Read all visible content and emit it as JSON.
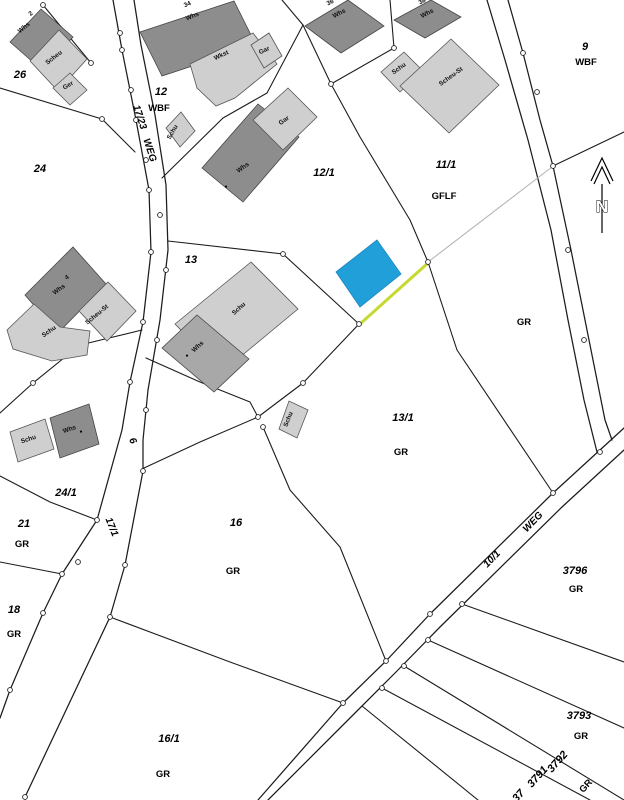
{
  "map": {
    "type": "cadastral-parcel-map",
    "north_label": "N",
    "colors": {
      "highlight_parcel": "#219fd9",
      "highlight_boundary": "#c6d92f",
      "boundary_line": "#1c1c1c",
      "building_dark": "#8d8d8d",
      "building_medium": "#a8a8a8",
      "building_light": "#cfcfcf",
      "auxiliary_line": "#b5b5b5",
      "background": "#ffffff"
    },
    "labels": [
      {
        "t": "26",
        "x": 20,
        "y": 78,
        "r": 0,
        "c": "parcel",
        "n": "parcel-26"
      },
      {
        "t": "24",
        "x": 40,
        "y": 172,
        "r": 0,
        "c": "parcel",
        "n": "parcel-24"
      },
      {
        "t": "12",
        "x": 161,
        "y": 95,
        "r": 0,
        "c": "parcel",
        "n": "parcel-12"
      },
      {
        "t": "WBF",
        "x": 159,
        "y": 111,
        "r": 0,
        "c": "use",
        "n": "use-wbf-12"
      },
      {
        "t": "12/1",
        "x": 324,
        "y": 176,
        "r": 0,
        "c": "parcel",
        "n": "parcel-12-1"
      },
      {
        "t": "11/1",
        "x": 446,
        "y": 168,
        "r": 0,
        "c": "parcel",
        "n": "parcel-11-1"
      },
      {
        "t": "GFLF",
        "x": 444,
        "y": 199,
        "r": 0,
        "c": "use",
        "n": "use-gflf-11-1"
      },
      {
        "t": "9",
        "x": 585,
        "y": 50,
        "r": 0,
        "c": "parcel",
        "n": "parcel-9"
      },
      {
        "t": "WBF",
        "x": 586,
        "y": 65,
        "r": 0,
        "c": "use",
        "n": "use-wbf-9"
      },
      {
        "t": "13",
        "x": 191,
        "y": 263,
        "r": 0,
        "c": "parcel",
        "n": "parcel-13"
      },
      {
        "t": "13/1",
        "x": 403,
        "y": 421,
        "r": 0,
        "c": "parcel",
        "n": "parcel-13-1"
      },
      {
        "t": "GR",
        "x": 401,
        "y": 455,
        "r": 0,
        "c": "use",
        "n": "use-gr-13-1"
      },
      {
        "t": "GR",
        "x": 524,
        "y": 325,
        "r": 0,
        "c": "use",
        "n": "use-gr-right"
      },
      {
        "t": "24/1",
        "x": 66,
        "y": 496,
        "r": 0,
        "c": "parcel",
        "n": "parcel-24-1"
      },
      {
        "t": "21",
        "x": 24,
        "y": 527,
        "r": 0,
        "c": "parcel",
        "n": "parcel-21"
      },
      {
        "t": "GR",
        "x": 22,
        "y": 547,
        "r": 0,
        "c": "use",
        "n": "use-gr-21"
      },
      {
        "t": "16",
        "x": 236,
        "y": 526,
        "r": 0,
        "c": "parcel",
        "n": "parcel-16"
      },
      {
        "t": "GR",
        "x": 233,
        "y": 574,
        "r": 0,
        "c": "use",
        "n": "use-gr-16"
      },
      {
        "t": "18",
        "x": 14,
        "y": 613,
        "r": 0,
        "c": "parcel",
        "n": "parcel-18"
      },
      {
        "t": "GR",
        "x": 14,
        "y": 637,
        "r": 0,
        "c": "use",
        "n": "use-gr-18"
      },
      {
        "t": "16/1",
        "x": 169,
        "y": 742,
        "r": 0,
        "c": "parcel",
        "n": "parcel-16-1"
      },
      {
        "t": "GR",
        "x": 163,
        "y": 777,
        "r": 0,
        "c": "use",
        "n": "use-gr-16-1"
      },
      {
        "t": "3796",
        "x": 575,
        "y": 574,
        "r": 0,
        "c": "parcel",
        "n": "parcel-3796"
      },
      {
        "t": "GR",
        "x": 576,
        "y": 592,
        "r": 0,
        "c": "use",
        "n": "use-gr-3796"
      },
      {
        "t": "3793",
        "x": 579,
        "y": 719,
        "r": 0,
        "c": "parcel",
        "n": "parcel-3793"
      },
      {
        "t": "GR",
        "x": 581,
        "y": 739,
        "r": 0,
        "c": "use",
        "n": "use-gr-3793"
      },
      {
        "t": "3792",
        "x": 560,
        "y": 764,
        "r": -48,
        "c": "parcel",
        "n": "parcel-3792"
      },
      {
        "t": "3791",
        "x": 540,
        "y": 779,
        "r": -48,
        "c": "parcel",
        "n": "parcel-3791"
      },
      {
        "t": "GR",
        "x": 588,
        "y": 788,
        "r": -48,
        "c": "use",
        "n": "use-gr-3792"
      },
      {
        "t": "37",
        "x": 521,
        "y": 798,
        "r": -48,
        "c": "parcel",
        "n": "parcel-37-clipped"
      },
      {
        "t": "17/23",
        "x": 137,
        "y": 118,
        "r": 72,
        "c": "road",
        "n": "road-17-23"
      },
      {
        "t": "WEG",
        "x": 147,
        "y": 151,
        "r": 72,
        "c": "road",
        "n": "road-weg-left"
      },
      {
        "t": "6",
        "x": 130,
        "y": 442,
        "r": 65,
        "c": "road",
        "n": "road-6"
      },
      {
        "t": "17/1",
        "x": 109,
        "y": 528,
        "r": 68,
        "c": "road",
        "n": "road-17-1"
      },
      {
        "t": "10/1",
        "x": 494,
        "y": 561,
        "r": -46,
        "c": "road",
        "n": "road-10-1"
      },
      {
        "t": "WEG",
        "x": 535,
        "y": 524,
        "r": -46,
        "c": "road",
        "n": "road-weg-right"
      },
      {
        "t": "Whs",
        "x": 25,
        "y": 29,
        "r": -40,
        "c": "bld",
        "n": "bld-whs-26"
      },
      {
        "t": "2",
        "x": 32,
        "y": 15,
        "r": -40,
        "c": "bld",
        "n": "houseno-2"
      },
      {
        "t": "Scheu",
        "x": 55,
        "y": 59,
        "r": -38,
        "c": "bld",
        "n": "bld-scheu-26"
      },
      {
        "t": "Ger",
        "x": 69,
        "y": 87,
        "r": -30,
        "c": "bld",
        "n": "bld-ger-26"
      },
      {
        "t": "34",
        "x": 188,
        "y": 6,
        "r": -22,
        "c": "bld",
        "n": "houseno-34"
      },
      {
        "t": "Whs",
        "x": 193,
        "y": 18,
        "r": -22,
        "c": "bld",
        "n": "bld-whs-34"
      },
      {
        "t": "Wkst",
        "x": 222,
        "y": 57,
        "r": -25,
        "c": "bld",
        "n": "bld-wkst"
      },
      {
        "t": "Gar",
        "x": 265,
        "y": 52,
        "r": -25,
        "c": "bld",
        "n": "bld-gar-12"
      },
      {
        "t": "Schu",
        "x": 174,
        "y": 133,
        "r": -60,
        "c": "bld",
        "n": "bld-schu-12"
      },
      {
        "t": "Whs",
        "x": 244,
        "y": 169,
        "r": -36,
        "c": "bld",
        "n": "bld-whs-12-1"
      },
      {
        "t": "Gar",
        "x": 285,
        "y": 122,
        "r": -36,
        "c": "bld",
        "n": "bld-gar-12-1"
      },
      {
        "t": "36",
        "x": 331,
        "y": 4,
        "r": -28,
        "c": "bld",
        "n": "houseno-36"
      },
      {
        "t": "Whs",
        "x": 340,
        "y": 15,
        "r": -28,
        "c": "bld",
        "n": "bld-whs-36"
      },
      {
        "t": "38",
        "x": 423,
        "y": 3,
        "r": -28,
        "c": "bld",
        "n": "houseno-38"
      },
      {
        "t": "Whs",
        "x": 428,
        "y": 15,
        "r": -28,
        "c": "bld",
        "n": "bld-whs-38"
      },
      {
        "t": "Schu",
        "x": 400,
        "y": 70,
        "r": -36,
        "c": "bld",
        "n": "bld-schu-11-1"
      },
      {
        "t": "Scheu-St",
        "x": 452,
        "y": 78,
        "r": -36,
        "c": "bld",
        "n": "bld-scheust-11-1"
      },
      {
        "t": "4",
        "x": 68,
        "y": 279,
        "r": -35,
        "c": "bld",
        "n": "houseno-4"
      },
      {
        "t": "Whs",
        "x": 60,
        "y": 291,
        "r": -35,
        "c": "bld",
        "n": "bld-whs-4"
      },
      {
        "t": "Scheu-St",
        "x": 98,
        "y": 316,
        "r": -40,
        "c": "bld",
        "n": "bld-scheust-left"
      },
      {
        "t": "Schu",
        "x": 50,
        "y": 333,
        "r": -35,
        "c": "bld",
        "n": "bld-schu-left"
      },
      {
        "t": "Schu",
        "x": 240,
        "y": 310,
        "r": -42,
        "c": "bld",
        "n": "bld-schu-13"
      },
      {
        "t": "Whs",
        "x": 199,
        "y": 348,
        "r": -42,
        "c": "bld",
        "n": "bld-whs-13"
      },
      {
        "t": "Schu",
        "x": 29,
        "y": 441,
        "r": -18,
        "c": "bld",
        "n": "bld-schu-24-1"
      },
      {
        "t": "Whs",
        "x": 70,
        "y": 431,
        "r": -18,
        "c": "bld",
        "n": "bld-whs-24-1"
      },
      {
        "t": "Schu",
        "x": 290,
        "y": 420,
        "r": -68,
        "c": "bld",
        "n": "bld-schu-13-1"
      },
      {
        "t": "●",
        "x": 226,
        "y": 188,
        "r": 0,
        "c": "dot",
        "n": "houseno-dot-1"
      },
      {
        "t": "●",
        "x": 187,
        "y": 357,
        "r": 0,
        "c": "dot",
        "n": "houseno-dot-2"
      },
      {
        "t": "●",
        "x": 81,
        "y": 433,
        "r": 0,
        "c": "dot",
        "n": "houseno-dot-3"
      }
    ]
  }
}
